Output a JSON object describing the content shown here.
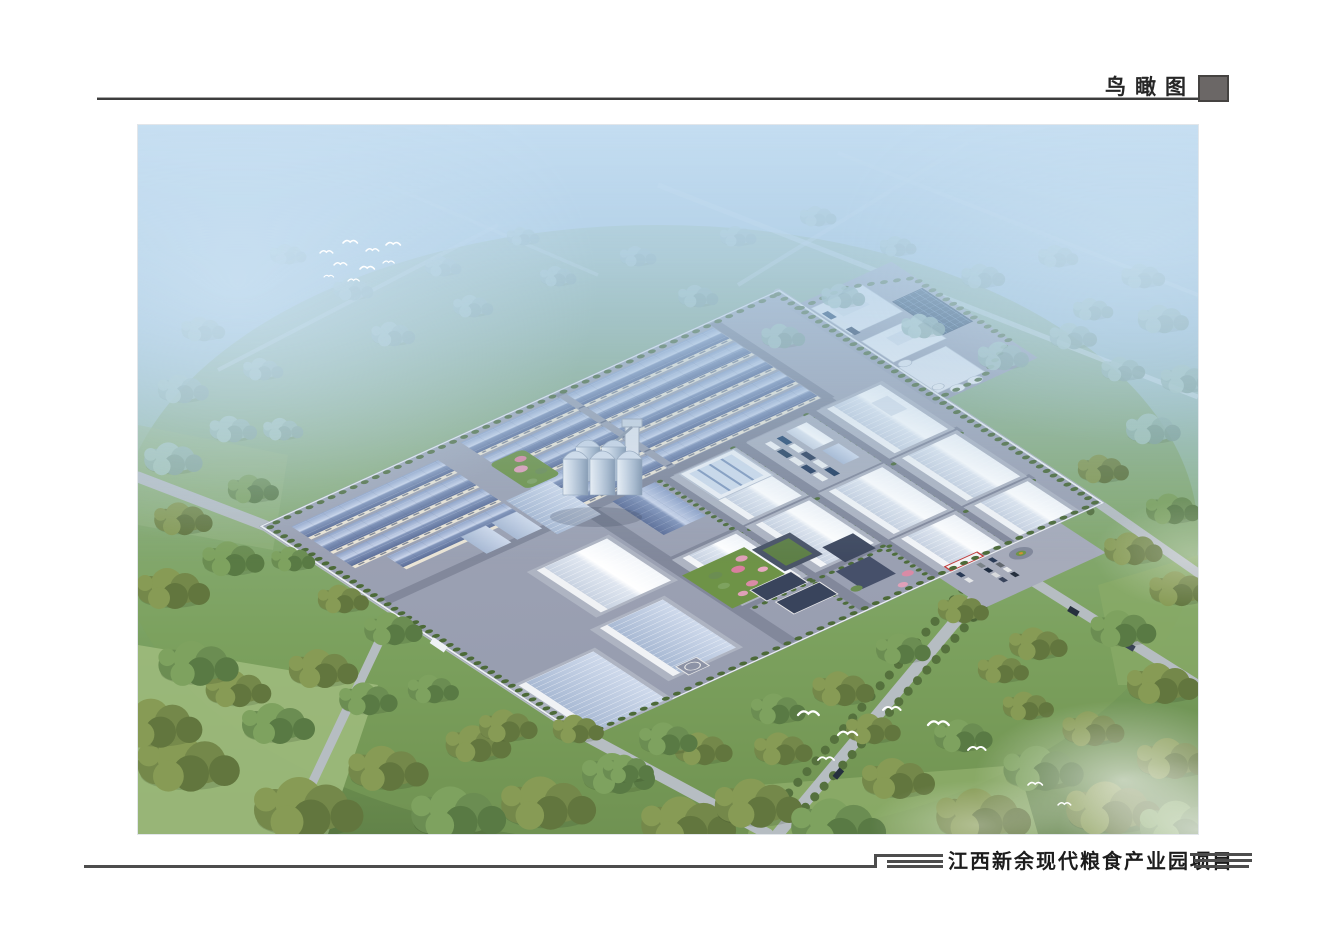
{
  "header": {
    "title": "鸟瞰图",
    "square_color": "#6b6766",
    "rule_color": "#3d3d3d"
  },
  "footer": {
    "project_name": "江西新余现代粮食产业园项目",
    "line_color": "#4d4d4d"
  },
  "scene": {
    "type": "aerial-architectural-rendering",
    "description": "现代粮食产业园鸟瞰效果图：中部为厂区（蓝顶仓库群、白色大型仓库、筒仓、加工车间、办公楼、大门广场），四周为绿化林带、道路与农田，远景蓝色雾霭，白鹭飞翔",
    "palette": {
      "sky_haze": "#bcd7ec",
      "foliage": "#74884a",
      "blue_roof": "#7b8fb8",
      "white_building": "#f2f4f7",
      "concrete": "#9aa0b1",
      "road": "#b6bdc2",
      "pink_trees": "#e0a0b8",
      "lawn": "#6e9347"
    }
  }
}
